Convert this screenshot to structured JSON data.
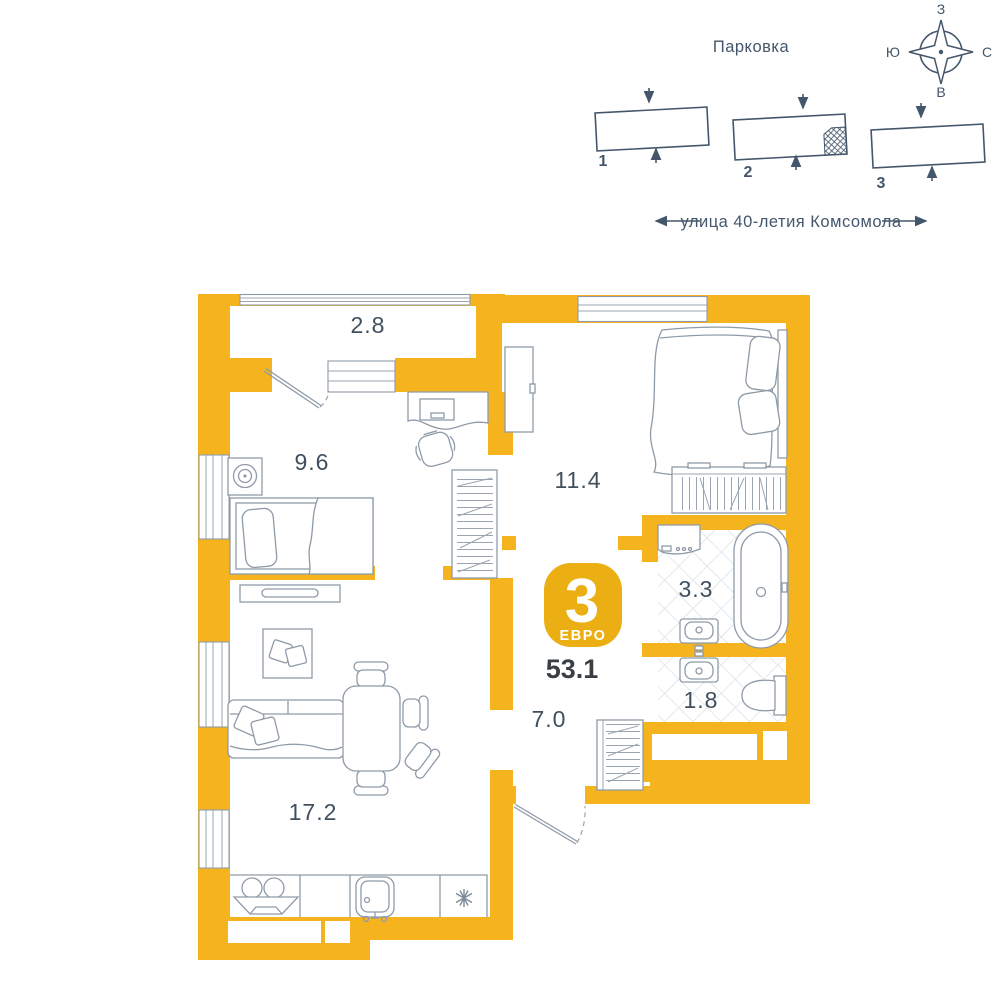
{
  "site_plan": {
    "parking_label": "Парковка",
    "street_label": "улица 40-летия Комсомола",
    "compass": {
      "top": "З",
      "right": "С",
      "bottom": "В",
      "left": "Ю"
    },
    "buildings": [
      {
        "number": "1"
      },
      {
        "number": "2"
      },
      {
        "number": "3"
      }
    ]
  },
  "apartment": {
    "badge": {
      "rooms_count": "3",
      "layout_type": "ЕВРО",
      "total_area": "53.1"
    },
    "rooms": {
      "balcony": "2.8",
      "bedroom_small": "9.6",
      "bedroom_master": "11.4",
      "bathroom": "3.3",
      "wc": "1.8",
      "hallway": "7.0",
      "living_kitchen": "17.2"
    },
    "icons": {
      "fridge": "snowflake-icon",
      "compass": "compass-rose-icon"
    }
  },
  "colors": {
    "wall": "#F5B41E",
    "badge": "#EBAF14",
    "furniture_line": "#8E9AA8",
    "label_text": "#414F5D",
    "site_text": "#44566B",
    "tile_line": "#D5DBE0"
  }
}
